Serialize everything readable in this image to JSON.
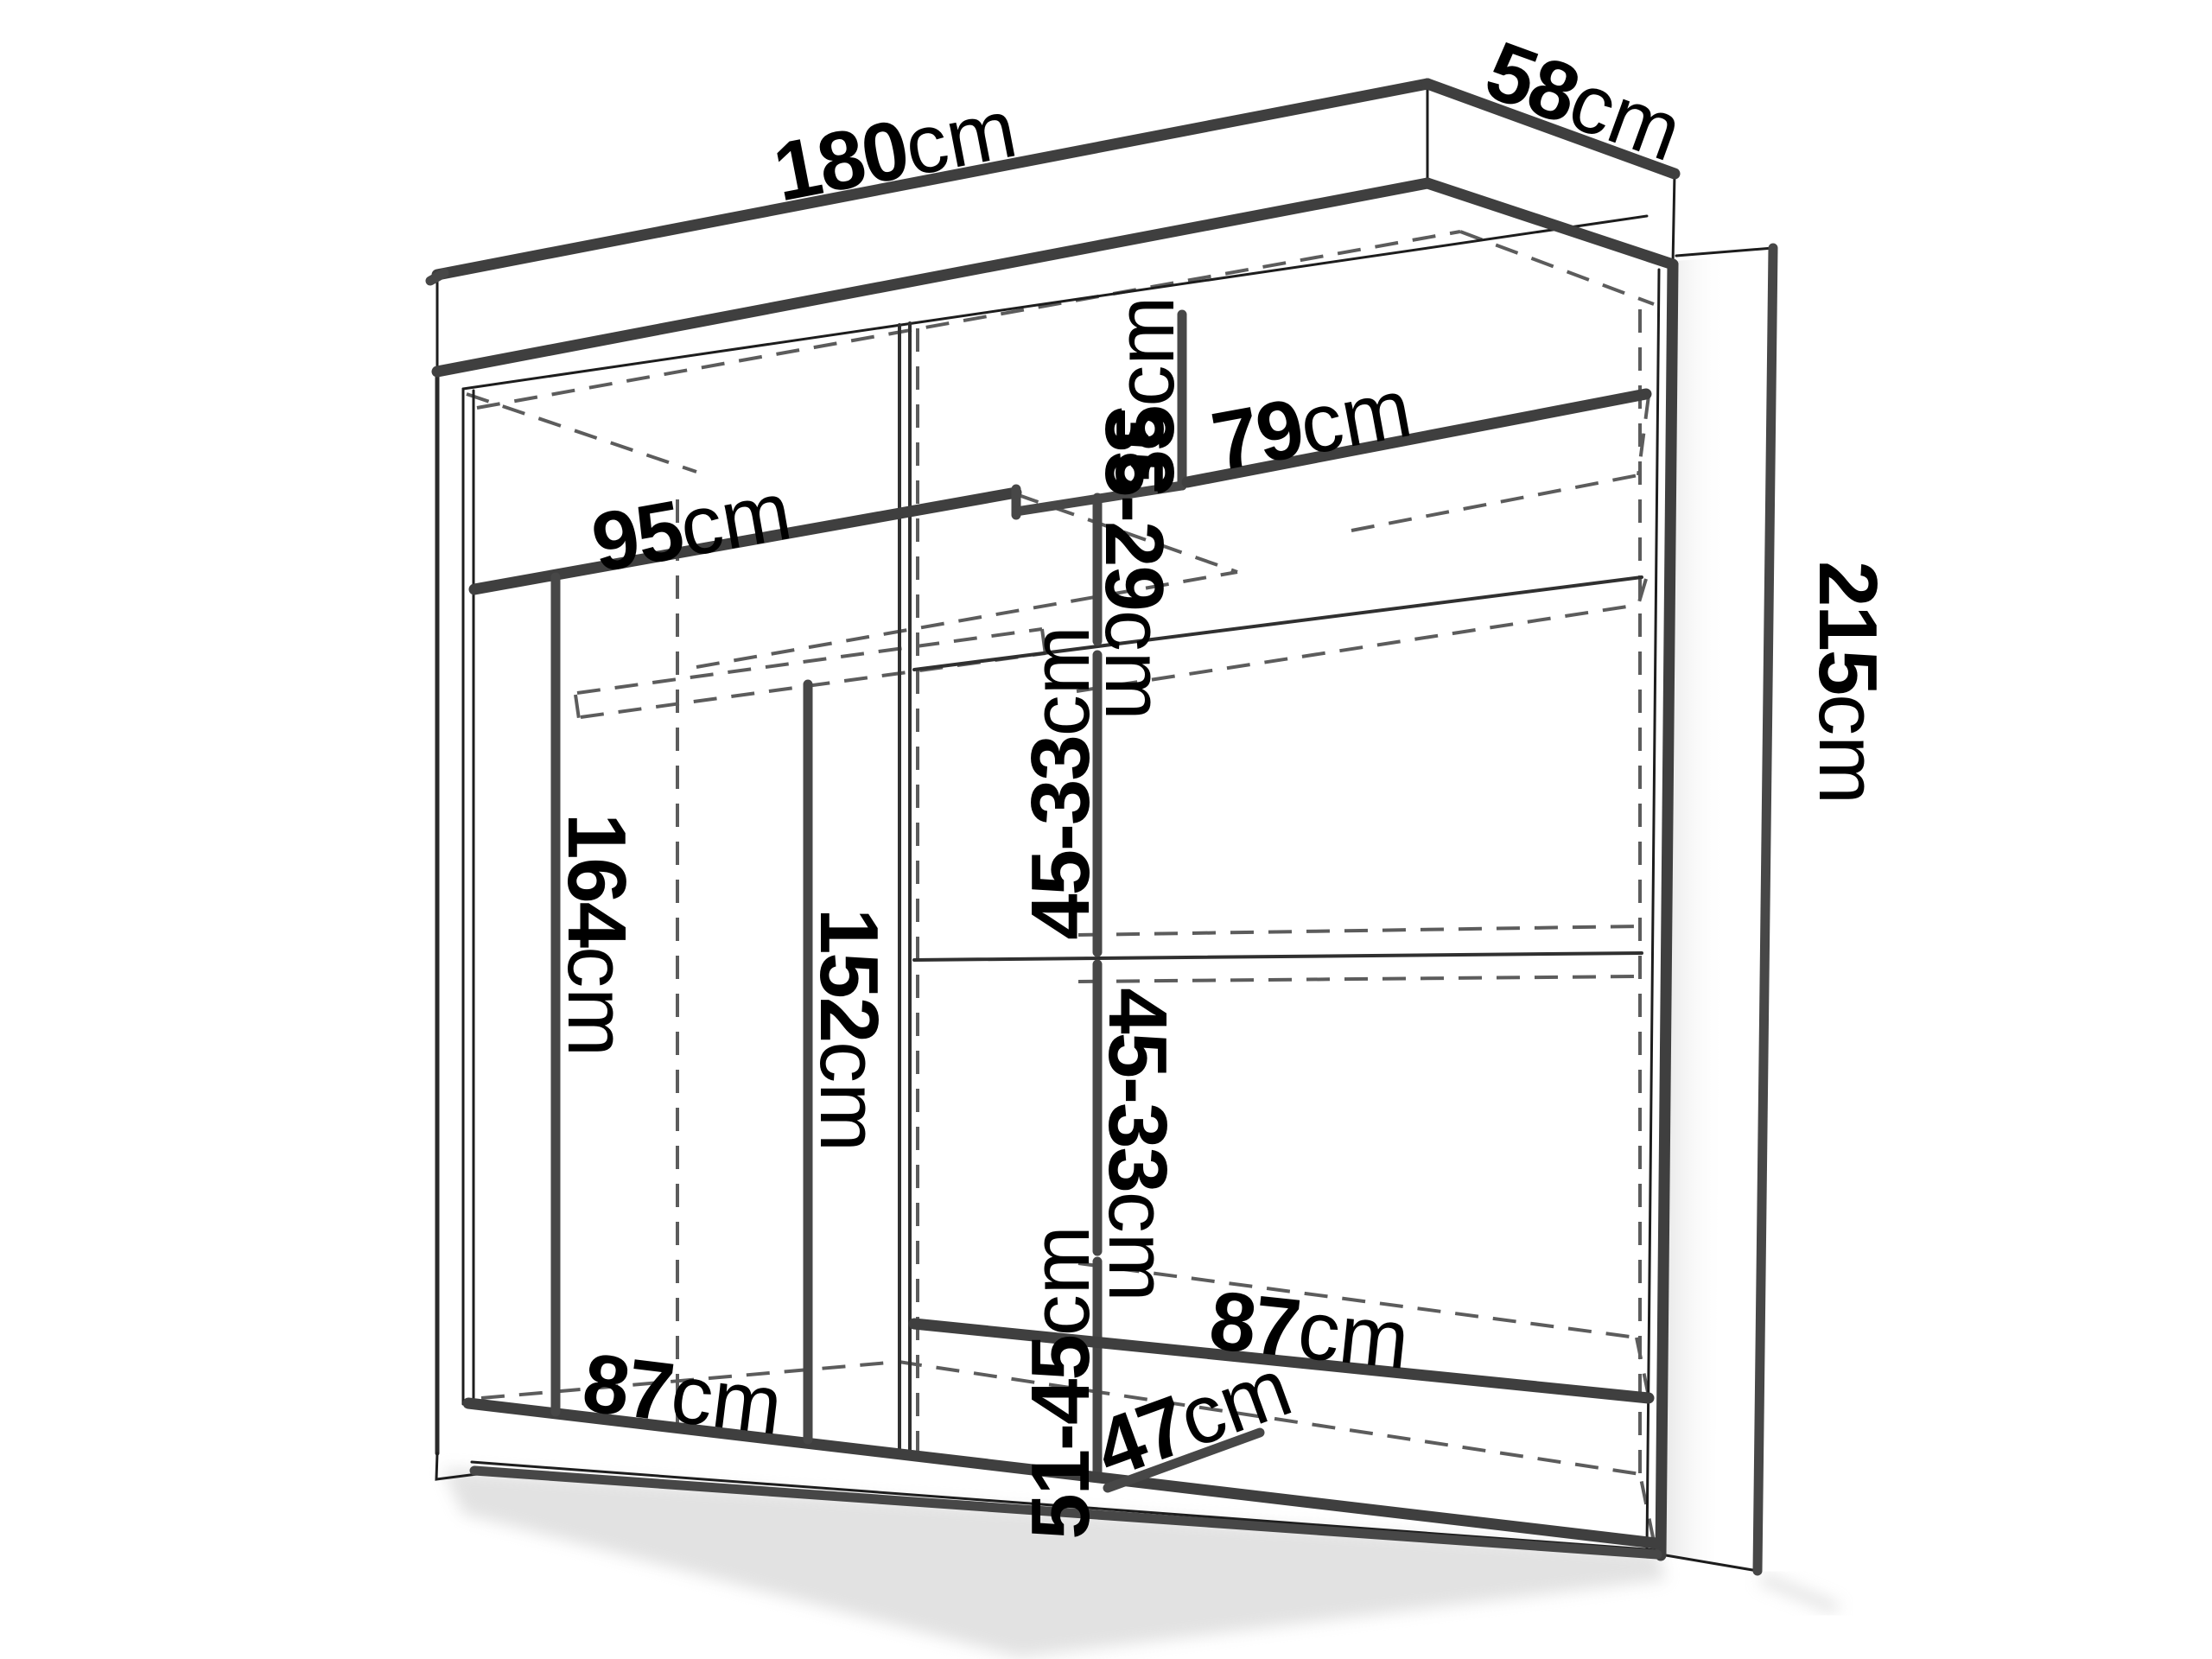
{
  "diagram": {
    "kind": "furniture-dimension-diagram",
    "subject": "sliding-door wardrobe with interior shelving",
    "units": "cm",
    "overall": {
      "width": "180cm",
      "depth": "58cm",
      "height": "215cm"
    },
    "labels": [
      {
        "id": "overall-width",
        "value": "180",
        "unit": "cm"
      },
      {
        "id": "overall-depth",
        "value": "58",
        "unit": "cm"
      },
      {
        "id": "overall-height",
        "value": "215",
        "unit": "cm"
      },
      {
        "id": "top-shelf-left-width",
        "value": "95",
        "unit": "cm"
      },
      {
        "id": "top-slot-height",
        "value": "35",
        "unit": "cm"
      },
      {
        "id": "top-shelf-right-width",
        "value": "79",
        "unit": "cm"
      },
      {
        "id": "gap-35-29",
        "value": "35-29",
        "unit": "cm"
      },
      {
        "id": "gap-45-33-upper",
        "value": "45-33",
        "unit": "cm"
      },
      {
        "id": "gap-45-33-lower",
        "value": "45-33",
        "unit": "cm"
      },
      {
        "id": "shelf-right-width",
        "value": "87",
        "unit": "cm"
      },
      {
        "id": "gap-51-45",
        "value": "51-45",
        "unit": "cm"
      },
      {
        "id": "bottom-depth",
        "value": "47",
        "unit": "cm"
      },
      {
        "id": "shelf-left-width",
        "value": "87",
        "unit": "cm"
      },
      {
        "id": "hanging-height-left",
        "value": "164",
        "unit": "cm"
      },
      {
        "id": "hanging-height-mid",
        "value": "152",
        "unit": "cm"
      }
    ]
  }
}
